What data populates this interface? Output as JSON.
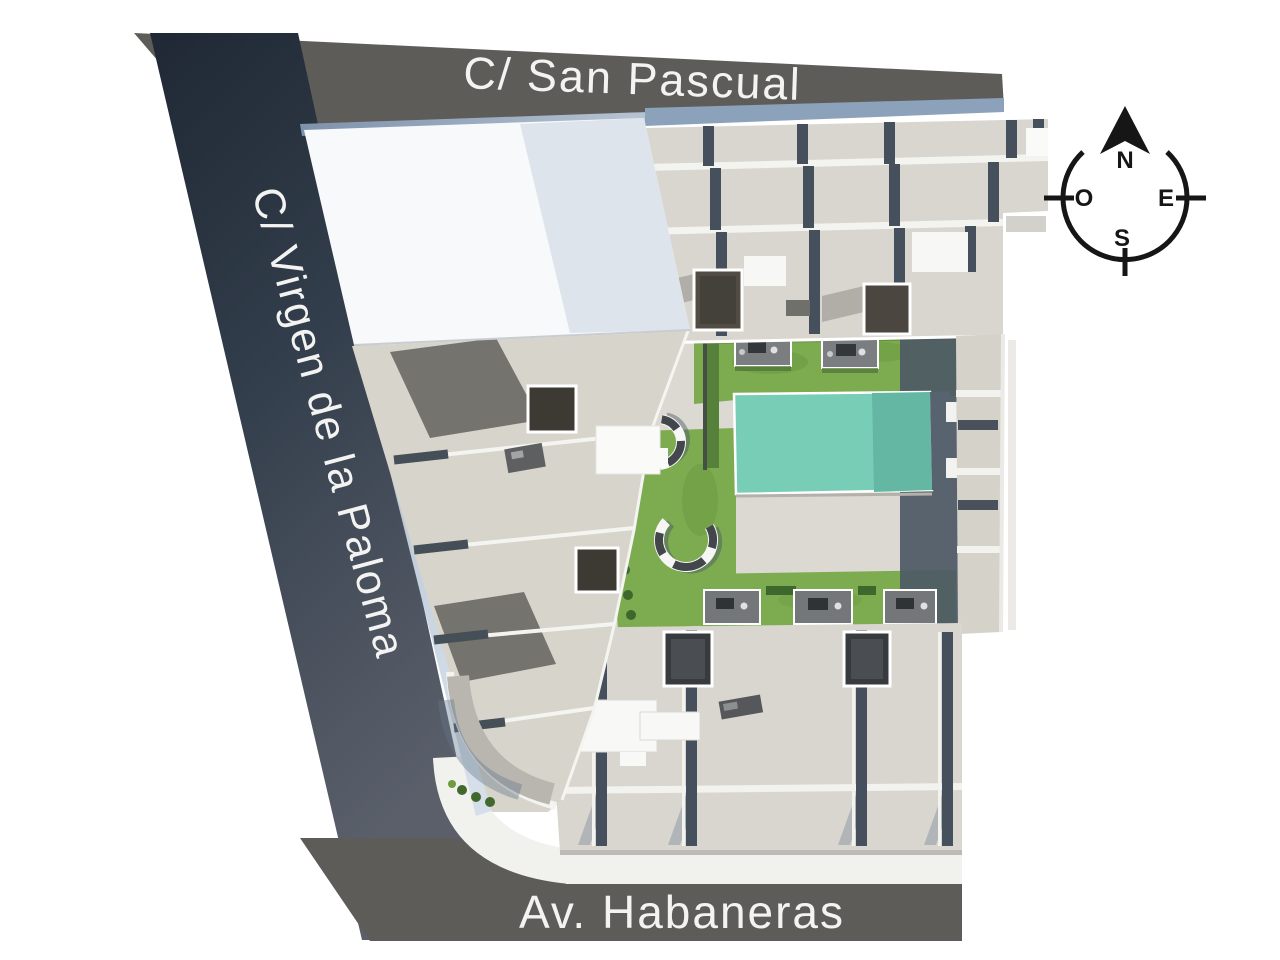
{
  "plan": {
    "streets": {
      "top": "C/ San Pascual",
      "left": "C/ Virgen de la Paloma",
      "bottom": "Av. Habaneras"
    },
    "compass": {
      "north": "N",
      "east": "E",
      "south": "S",
      "west": "O"
    },
    "palette": {
      "street_band_gray": "#5e5c59",
      "street_band_navy": "#333e4c",
      "street_label_text": "#f3f3f2",
      "roof_beige": "#d9d6cf",
      "roof_white": "#f8f9fb",
      "courtyard_paving": "#dcd9d2",
      "garden_green": "#7dab50",
      "pool_teal": "#78cdb6",
      "pool_edge": "#57636e",
      "building_shadow": "#4d5965",
      "compass_ink": "#161616"
    },
    "site_elements": [
      "rooftop terraces",
      "communal garden",
      "swimming pool",
      "curved garden benches",
      "ground-floor patios",
      "skylights"
    ]
  }
}
